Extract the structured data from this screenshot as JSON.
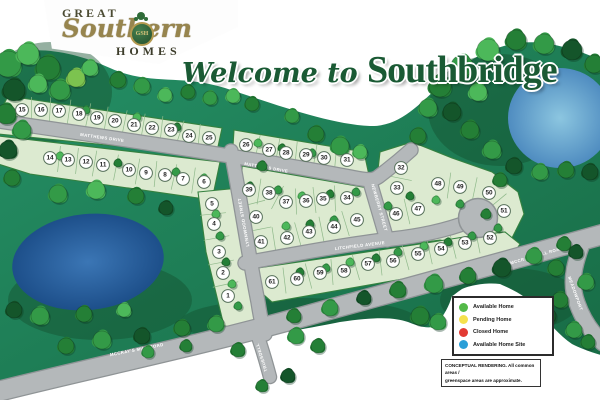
{
  "logo": {
    "line1": "GREAT",
    "script": "Southern",
    "monogram": "GSH",
    "line2": "HOMES"
  },
  "title": {
    "prefix": "Welcome to ",
    "name": "Southbridge"
  },
  "legend": {
    "items": [
      {
        "label": "Available Home",
        "color": "#53b948"
      },
      {
        "label": "Pending Home",
        "color": "#f5e14d"
      },
      {
        "label": "Closed Home",
        "color": "#e23b33"
      },
      {
        "label": "Available Home Site",
        "color": "#2a9fd8"
      }
    ]
  },
  "disclaimer": {
    "line1": "CONCEPTUAL RENDERING. All common areas /",
    "line2": "greenspace areas are approximate."
  },
  "roads": [
    {
      "id": "matthews",
      "name": "MATTHEWS DRIVE"
    },
    {
      "id": "newberry",
      "name": "NEWBERRY STREET"
    },
    {
      "id": "litchfield",
      "name": "LITCHFIELD AVENUE"
    },
    {
      "id": "lynnwood",
      "name": "LYNNWOOD STREET"
    },
    {
      "id": "mccrays",
      "name": "MCCRAY'S MILL ROAD"
    },
    {
      "id": "truesdell",
      "name": "TRUESDELL"
    },
    {
      "id": "meadowport",
      "name": "MEADOWPORT"
    }
  ],
  "colors": {
    "land": "#1f8157",
    "land_dark": "#14502f",
    "parcel": "#dcead0",
    "parcel_edge": "#35813f",
    "road": "#b4b8ba",
    "road_edge": "#8f9496",
    "pond_left": "#1d4f8a",
    "pond_right": "#8cc6e0",
    "marker_fill": "#ffffff",
    "marker_edge": "#56705a",
    "marker_text": "#222222"
  },
  "lots": [
    {
      "n": 1,
      "x": 228,
      "y": 296
    },
    {
      "n": 2,
      "x": 223,
      "y": 273
    },
    {
      "n": 3,
      "x": 219,
      "y": 252
    },
    {
      "n": 4,
      "x": 214,
      "y": 224
    },
    {
      "n": 5,
      "x": 212,
      "y": 204
    },
    {
      "n": 6,
      "x": 204,
      "y": 182
    },
    {
      "n": 7,
      "x": 183,
      "y": 179
    },
    {
      "n": 8,
      "x": 165,
      "y": 175
    },
    {
      "n": 9,
      "x": 146,
      "y": 173
    },
    {
      "n": 10,
      "x": 129,
      "y": 170
    },
    {
      "n": 11,
      "x": 103,
      "y": 165
    },
    {
      "n": 12,
      "x": 86,
      "y": 162
    },
    {
      "n": 13,
      "x": 68,
      "y": 160
    },
    {
      "n": 14,
      "x": 50,
      "y": 158
    },
    {
      "n": 15,
      "x": 22,
      "y": 110
    },
    {
      "n": 16,
      "x": 41,
      "y": 110
    },
    {
      "n": 17,
      "x": 59,
      "y": 111
    },
    {
      "n": 18,
      "x": 79,
      "y": 114
    },
    {
      "n": 19,
      "x": 97,
      "y": 118
    },
    {
      "n": 20,
      "x": 115,
      "y": 121
    },
    {
      "n": 21,
      "x": 134,
      "y": 125
    },
    {
      "n": 22,
      "x": 152,
      "y": 128
    },
    {
      "n": 23,
      "x": 171,
      "y": 130
    },
    {
      "n": 24,
      "x": 189,
      "y": 136
    },
    {
      "n": 25,
      "x": 209,
      "y": 138
    },
    {
      "n": 26,
      "x": 246,
      "y": 145
    },
    {
      "n": 27,
      "x": 269,
      "y": 150
    },
    {
      "n": 28,
      "x": 286,
      "y": 153
    },
    {
      "n": 29,
      "x": 306,
      "y": 155
    },
    {
      "n": 30,
      "x": 324,
      "y": 158
    },
    {
      "n": 31,
      "x": 347,
      "y": 160
    },
    {
      "n": 32,
      "x": 401,
      "y": 168
    },
    {
      "n": 33,
      "x": 397,
      "y": 188
    },
    {
      "n": 34,
      "x": 347,
      "y": 198
    },
    {
      "n": 35,
      "x": 323,
      "y": 199
    },
    {
      "n": 36,
      "x": 306,
      "y": 201
    },
    {
      "n": 37,
      "x": 286,
      "y": 202
    },
    {
      "n": 38,
      "x": 269,
      "y": 193
    },
    {
      "n": 39,
      "x": 249,
      "y": 190
    },
    {
      "n": 40,
      "x": 256,
      "y": 217
    },
    {
      "n": 41,
      "x": 261,
      "y": 242
    },
    {
      "n": 42,
      "x": 287,
      "y": 238
    },
    {
      "n": 43,
      "x": 309,
      "y": 232
    },
    {
      "n": 44,
      "x": 334,
      "y": 227
    },
    {
      "n": 45,
      "x": 357,
      "y": 220
    },
    {
      "n": 46,
      "x": 396,
      "y": 214
    },
    {
      "n": 47,
      "x": 418,
      "y": 209
    },
    {
      "n": 48,
      "x": 438,
      "y": 184
    },
    {
      "n": 49,
      "x": 460,
      "y": 187
    },
    {
      "n": 50,
      "x": 489,
      "y": 193
    },
    {
      "n": 51,
      "x": 504,
      "y": 211
    },
    {
      "n": 52,
      "x": 490,
      "y": 238
    },
    {
      "n": 53,
      "x": 465,
      "y": 243
    },
    {
      "n": 54,
      "x": 441,
      "y": 249
    },
    {
      "n": 55,
      "x": 418,
      "y": 254
    },
    {
      "n": 56,
      "x": 393,
      "y": 261
    },
    {
      "n": 57,
      "x": 368,
      "y": 264
    },
    {
      "n": 58,
      "x": 344,
      "y": 271
    },
    {
      "n": 59,
      "x": 320,
      "y": 273
    },
    {
      "n": 60,
      "x": 297,
      "y": 279
    },
    {
      "n": 61,
      "x": 272,
      "y": 282
    }
  ],
  "trees": [
    [
      8,
      64,
      13,
      1
    ],
    [
      28,
      54,
      11,
      0
    ],
    [
      48,
      68,
      12,
      2
    ],
    [
      14,
      90,
      11,
      3
    ],
    [
      38,
      84,
      9,
      0
    ],
    [
      60,
      90,
      10,
      1
    ],
    [
      6,
      114,
      10,
      2
    ],
    [
      76,
      78,
      9,
      4
    ],
    [
      22,
      130,
      9,
      1
    ],
    [
      8,
      150,
      9,
      3
    ],
    [
      90,
      68,
      8,
      0
    ],
    [
      118,
      80,
      8,
      2
    ],
    [
      142,
      86,
      8,
      1
    ],
    [
      165,
      95,
      7,
      0
    ],
    [
      188,
      92,
      7,
      2
    ],
    [
      210,
      98,
      7,
      1
    ],
    [
      233,
      96,
      7,
      0
    ],
    [
      252,
      104,
      7,
      2
    ],
    [
      292,
      116,
      7,
      1
    ],
    [
      316,
      134,
      8,
      2
    ],
    [
      340,
      146,
      9,
      1
    ],
    [
      360,
      152,
      7,
      0
    ],
    [
      428,
      108,
      9,
      1
    ],
    [
      418,
      136,
      8,
      2
    ],
    [
      440,
      86,
      11,
      2
    ],
    [
      462,
      66,
      11,
      1
    ],
    [
      488,
      50,
      11,
      0
    ],
    [
      516,
      40,
      10,
      2
    ],
    [
      544,
      44,
      10,
      1
    ],
    [
      572,
      50,
      10,
      3
    ],
    [
      594,
      64,
      9,
      2
    ],
    [
      452,
      112,
      9,
      3
    ],
    [
      470,
      130,
      9,
      2
    ],
    [
      492,
      150,
      9,
      1
    ],
    [
      514,
      166,
      8,
      3
    ],
    [
      540,
      172,
      8,
      1
    ],
    [
      566,
      170,
      8,
      2
    ],
    [
      590,
      172,
      8,
      3
    ],
    [
      478,
      92,
      9,
      0
    ],
    [
      500,
      180,
      7,
      2
    ],
    [
      12,
      178,
      8,
      2
    ],
    [
      58,
      194,
      9,
      1
    ],
    [
      96,
      190,
      9,
      0
    ],
    [
      136,
      196,
      8,
      2
    ],
    [
      166,
      208,
      7,
      3
    ],
    [
      40,
      316,
      9,
      1
    ],
    [
      84,
      314,
      8,
      2
    ],
    [
      124,
      310,
      7,
      0
    ],
    [
      14,
      310,
      8,
      3
    ],
    [
      86,
      110,
      4,
      1
    ],
    [
      137,
      117,
      4,
      0
    ],
    [
      177,
      127,
      4,
      2
    ],
    [
      60,
      156,
      4,
      0
    ],
    [
      118,
      163,
      4,
      2
    ],
    [
      176,
      172,
      4,
      1
    ],
    [
      204,
      178,
      4,
      0
    ],
    [
      258,
      143,
      4,
      0
    ],
    [
      282,
      148,
      4,
      2
    ],
    [
      312,
      153,
      4,
      1
    ],
    [
      250,
      186,
      4,
      2
    ],
    [
      278,
      190,
      4,
      1
    ],
    [
      302,
      196,
      4,
      0
    ],
    [
      330,
      194,
      4,
      2
    ],
    [
      356,
      192,
      4,
      1
    ],
    [
      286,
      226,
      4,
      0
    ],
    [
      310,
      224,
      4,
      2
    ],
    [
      334,
      220,
      4,
      1
    ],
    [
      388,
      206,
      4,
      1
    ],
    [
      300,
      272,
      4,
      2
    ],
    [
      326,
      268,
      4,
      1
    ],
    [
      350,
      262,
      4,
      0
    ],
    [
      376,
      258,
      4,
      2
    ],
    [
      398,
      252,
      4,
      1
    ],
    [
      424,
      246,
      4,
      0
    ],
    [
      448,
      242,
      4,
      2
    ],
    [
      472,
      236,
      4,
      1
    ],
    [
      216,
      214,
      4,
      0
    ],
    [
      220,
      236,
      4,
      1
    ],
    [
      226,
      262,
      4,
      2
    ],
    [
      232,
      284,
      4,
      0
    ],
    [
      238,
      306,
      4,
      1
    ],
    [
      262,
      166,
      5,
      2
    ],
    [
      410,
      196,
      4,
      2
    ],
    [
      436,
      200,
      4,
      0
    ],
    [
      460,
      204,
      4,
      1
    ],
    [
      486,
      214,
      5,
      2
    ],
    [
      498,
      228,
      4,
      1
    ],
    [
      66,
      346,
      8,
      2
    ],
    [
      102,
      340,
      9,
      1
    ],
    [
      142,
      336,
      8,
      3
    ],
    [
      182,
      328,
      8,
      2
    ],
    [
      216,
      324,
      8,
      1
    ],
    [
      294,
      316,
      7,
      2
    ],
    [
      330,
      308,
      8,
      1
    ],
    [
      364,
      298,
      7,
      3
    ],
    [
      398,
      290,
      8,
      2
    ],
    [
      434,
      284,
      9,
      1
    ],
    [
      468,
      276,
      8,
      2
    ],
    [
      502,
      268,
      9,
      3
    ],
    [
      534,
      256,
      8,
      1
    ],
    [
      564,
      244,
      7,
      2
    ],
    [
      148,
      352,
      6,
      1
    ],
    [
      186,
      346,
      6,
      2
    ],
    [
      238,
      350,
      7,
      2
    ],
    [
      296,
      336,
      8,
      1
    ],
    [
      318,
      346,
      7,
      2
    ],
    [
      288,
      376,
      7,
      3
    ],
    [
      262,
      386,
      6,
      2
    ],
    [
      420,
      316,
      9,
      2
    ],
    [
      438,
      322,
      8,
      1
    ],
    [
      548,
      316,
      8,
      3
    ],
    [
      560,
      300,
      8,
      2
    ],
    [
      574,
      330,
      8,
      1
    ],
    [
      588,
      342,
      7,
      2
    ],
    [
      556,
      268,
      8,
      2
    ],
    [
      586,
      282,
      8,
      1
    ],
    [
      576,
      252,
      7,
      3
    ]
  ]
}
